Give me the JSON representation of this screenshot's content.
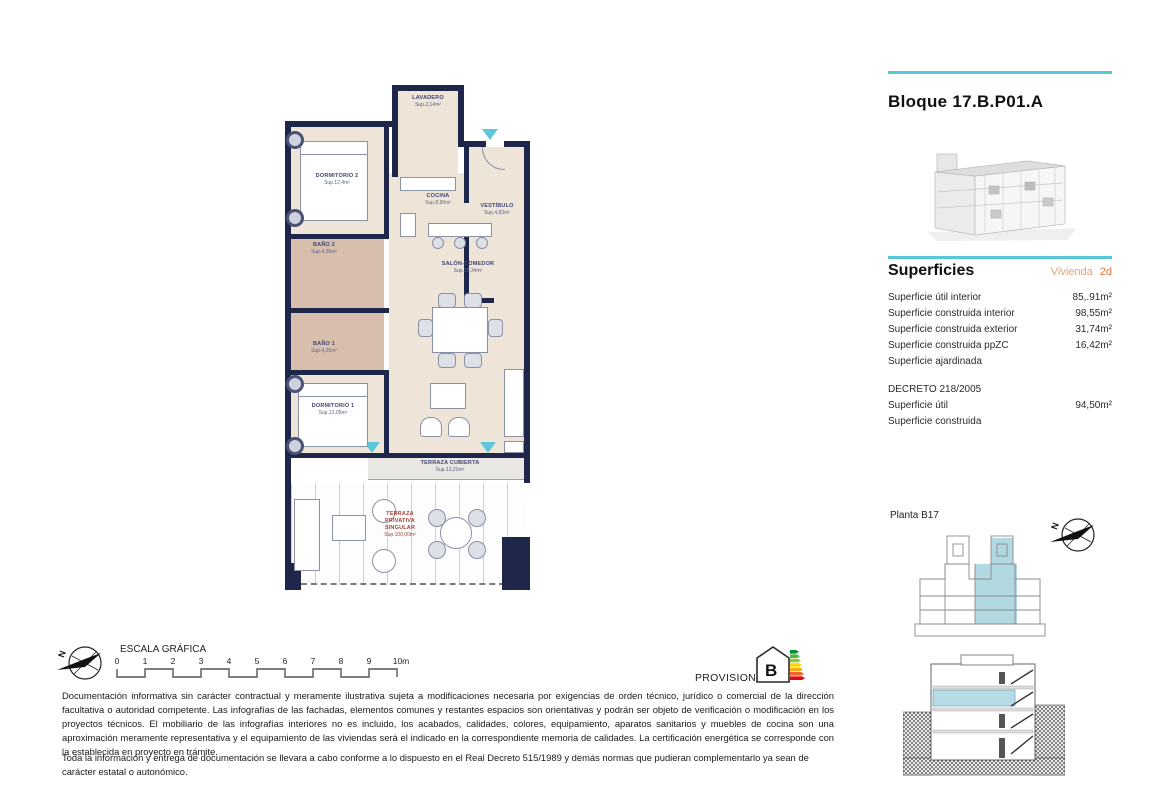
{
  "sidebar": {
    "title": "Bloque 17.B.P01.A",
    "superficies_heading": "Superficies",
    "vivienda_label": "Vivienda",
    "vivienda_value": "2d",
    "rows": [
      {
        "label": "Superficie útil interior",
        "value": "85,.91m²"
      },
      {
        "label": "Superficie construida interior",
        "value": "98,55m²"
      },
      {
        "label": "Superficie construida exterior",
        "value": "31,74m²"
      },
      {
        "label": "Superficie construida ppZC",
        "value": "16,42m²"
      },
      {
        "label": "Superficie ajardinada",
        "value": ""
      }
    ],
    "decreto_heading": "DECRETO 218/2005",
    "decreto_rows": [
      {
        "label": "Superficie útil",
        "value": "94,50m²"
      },
      {
        "label": "Superficie construida",
        "value": ""
      }
    ],
    "planta_label": "Planta B17"
  },
  "floorplan": {
    "rooms": {
      "lavadero": {
        "name": "LAVADERO",
        "area": "Sup.2,14m²"
      },
      "dormitorio2": {
        "name": "DORMITORIO 2",
        "area": "Sup.12,4m²"
      },
      "cocina": {
        "name": "COCINA",
        "area": "Sup.8,90m²"
      },
      "vestibulo": {
        "name": "VESTÍBULO",
        "area": "Sup.4,83m²"
      },
      "bano2": {
        "name": "BAÑO 2",
        "area": "Sup.4,25m²"
      },
      "bano1": {
        "name": "BAÑO 1",
        "area": "Sup.4,25m²"
      },
      "salon": {
        "name": "SALÓN-COMEDOR",
        "area": "Sup.28,34m²"
      },
      "dormitorio1": {
        "name": "DORMITORIO 1",
        "area": "Sup.13,05m²"
      },
      "terraza_cubierta": {
        "name": "TERRAZA CUBIERTA",
        "area": "Sup.13,20m²"
      },
      "terraza_privativa": {
        "line1": "TERRAZA",
        "line2": "PRIVATIVA",
        "line3": "SINGULAR",
        "area": "Sup.100,00m²"
      }
    }
  },
  "scale": {
    "label": "ESCALA GRÁFICA",
    "ticks": [
      "0",
      "1",
      "2",
      "3",
      "4",
      "5",
      "6",
      "7",
      "8",
      "9",
      "10m"
    ]
  },
  "compass": {
    "north": "N"
  },
  "footer": {
    "provisional": "PROVISIONAL",
    "energy_rating": "B",
    "paragraph1": "Documentación informativa sin carácter contractual y meramente ilustrativa sujeta a modificaciones necesaria por exigencias de orden técnico, jurídico o comercial de la dirección facultativa o autoridad competente. Las infografías de las fachadas, elementos comunes y restantes espacios son orientativas y podrán ser objeto de verificación o modificación en los proyectos técnicos. El mobiliario de las infografías interiores no es incluido, los acabados, calidades, colores, equipamiento, aparatos sanitarios y muebles de cocina son una aproximación meramente representativa y el equipamiento de las viviendas será el indicado en la correspondiente memoria de calidades. La certificación energética se corresponde con la establecida en proyecto en trámite.",
    "paragraph2": "Toda la información y entrega de documentación se llevara a cabo conforme a lo dispuesto en el Real Decreto 515/1989 y demás normas que pudieran complementarlo ya sean de carácter estatal o autonómico."
  },
  "colors": {
    "wall": "#1e2749",
    "floor": "#efe4d8",
    "bath_floor": "#d8bfad",
    "accent_cyan": "#57c7d9",
    "plan_highlight": "#b2d8e2",
    "vivienda_light": "#e8a27c",
    "vivienda_dark": "#d8773b",
    "terraza_label": "#9c4a3a",
    "energy_bars": [
      "#008f39",
      "#4db848",
      "#8dc63f",
      "#ffd500",
      "#fbab18",
      "#f1662a",
      "#e30613"
    ]
  }
}
